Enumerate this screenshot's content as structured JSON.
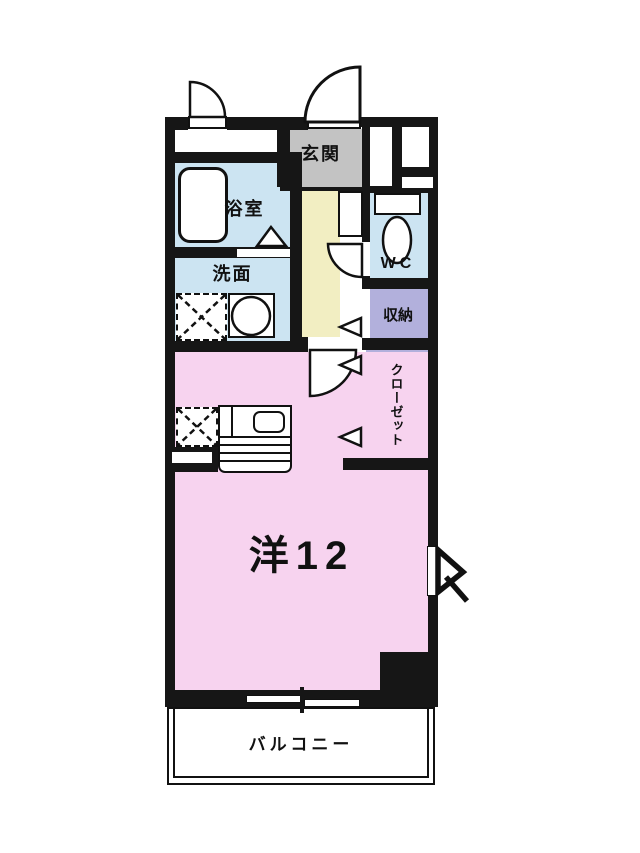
{
  "colors": {
    "wall": "#161616",
    "line": "#111111",
    "room-pink": "#f7d3ef",
    "water-blue": "#cce4f2",
    "closet-purple": "#b2b0dc",
    "hall-yellow": "#f2eec2",
    "genkan-gray": "#c3c3c3"
  },
  "rooms": {
    "genkan": {
      "label": "玄関",
      "color": "#c3c3c3"
    },
    "bath": {
      "label": "浴室",
      "color": "#cce4f2"
    },
    "washroom": {
      "label": "洗面",
      "color": "#cce4f2"
    },
    "wc": {
      "label": "WC",
      "color": "#cce4f2"
    },
    "storage": {
      "label": "収納",
      "color": "#b2b0dc"
    },
    "closet": {
      "label": "クローゼット",
      "color": "#b2b0dc"
    },
    "main_room": {
      "label": "洋12",
      "color": "#f7d3ef"
    },
    "balcony": {
      "label": "バルコニー",
      "color": "#ffffff"
    }
  }
}
